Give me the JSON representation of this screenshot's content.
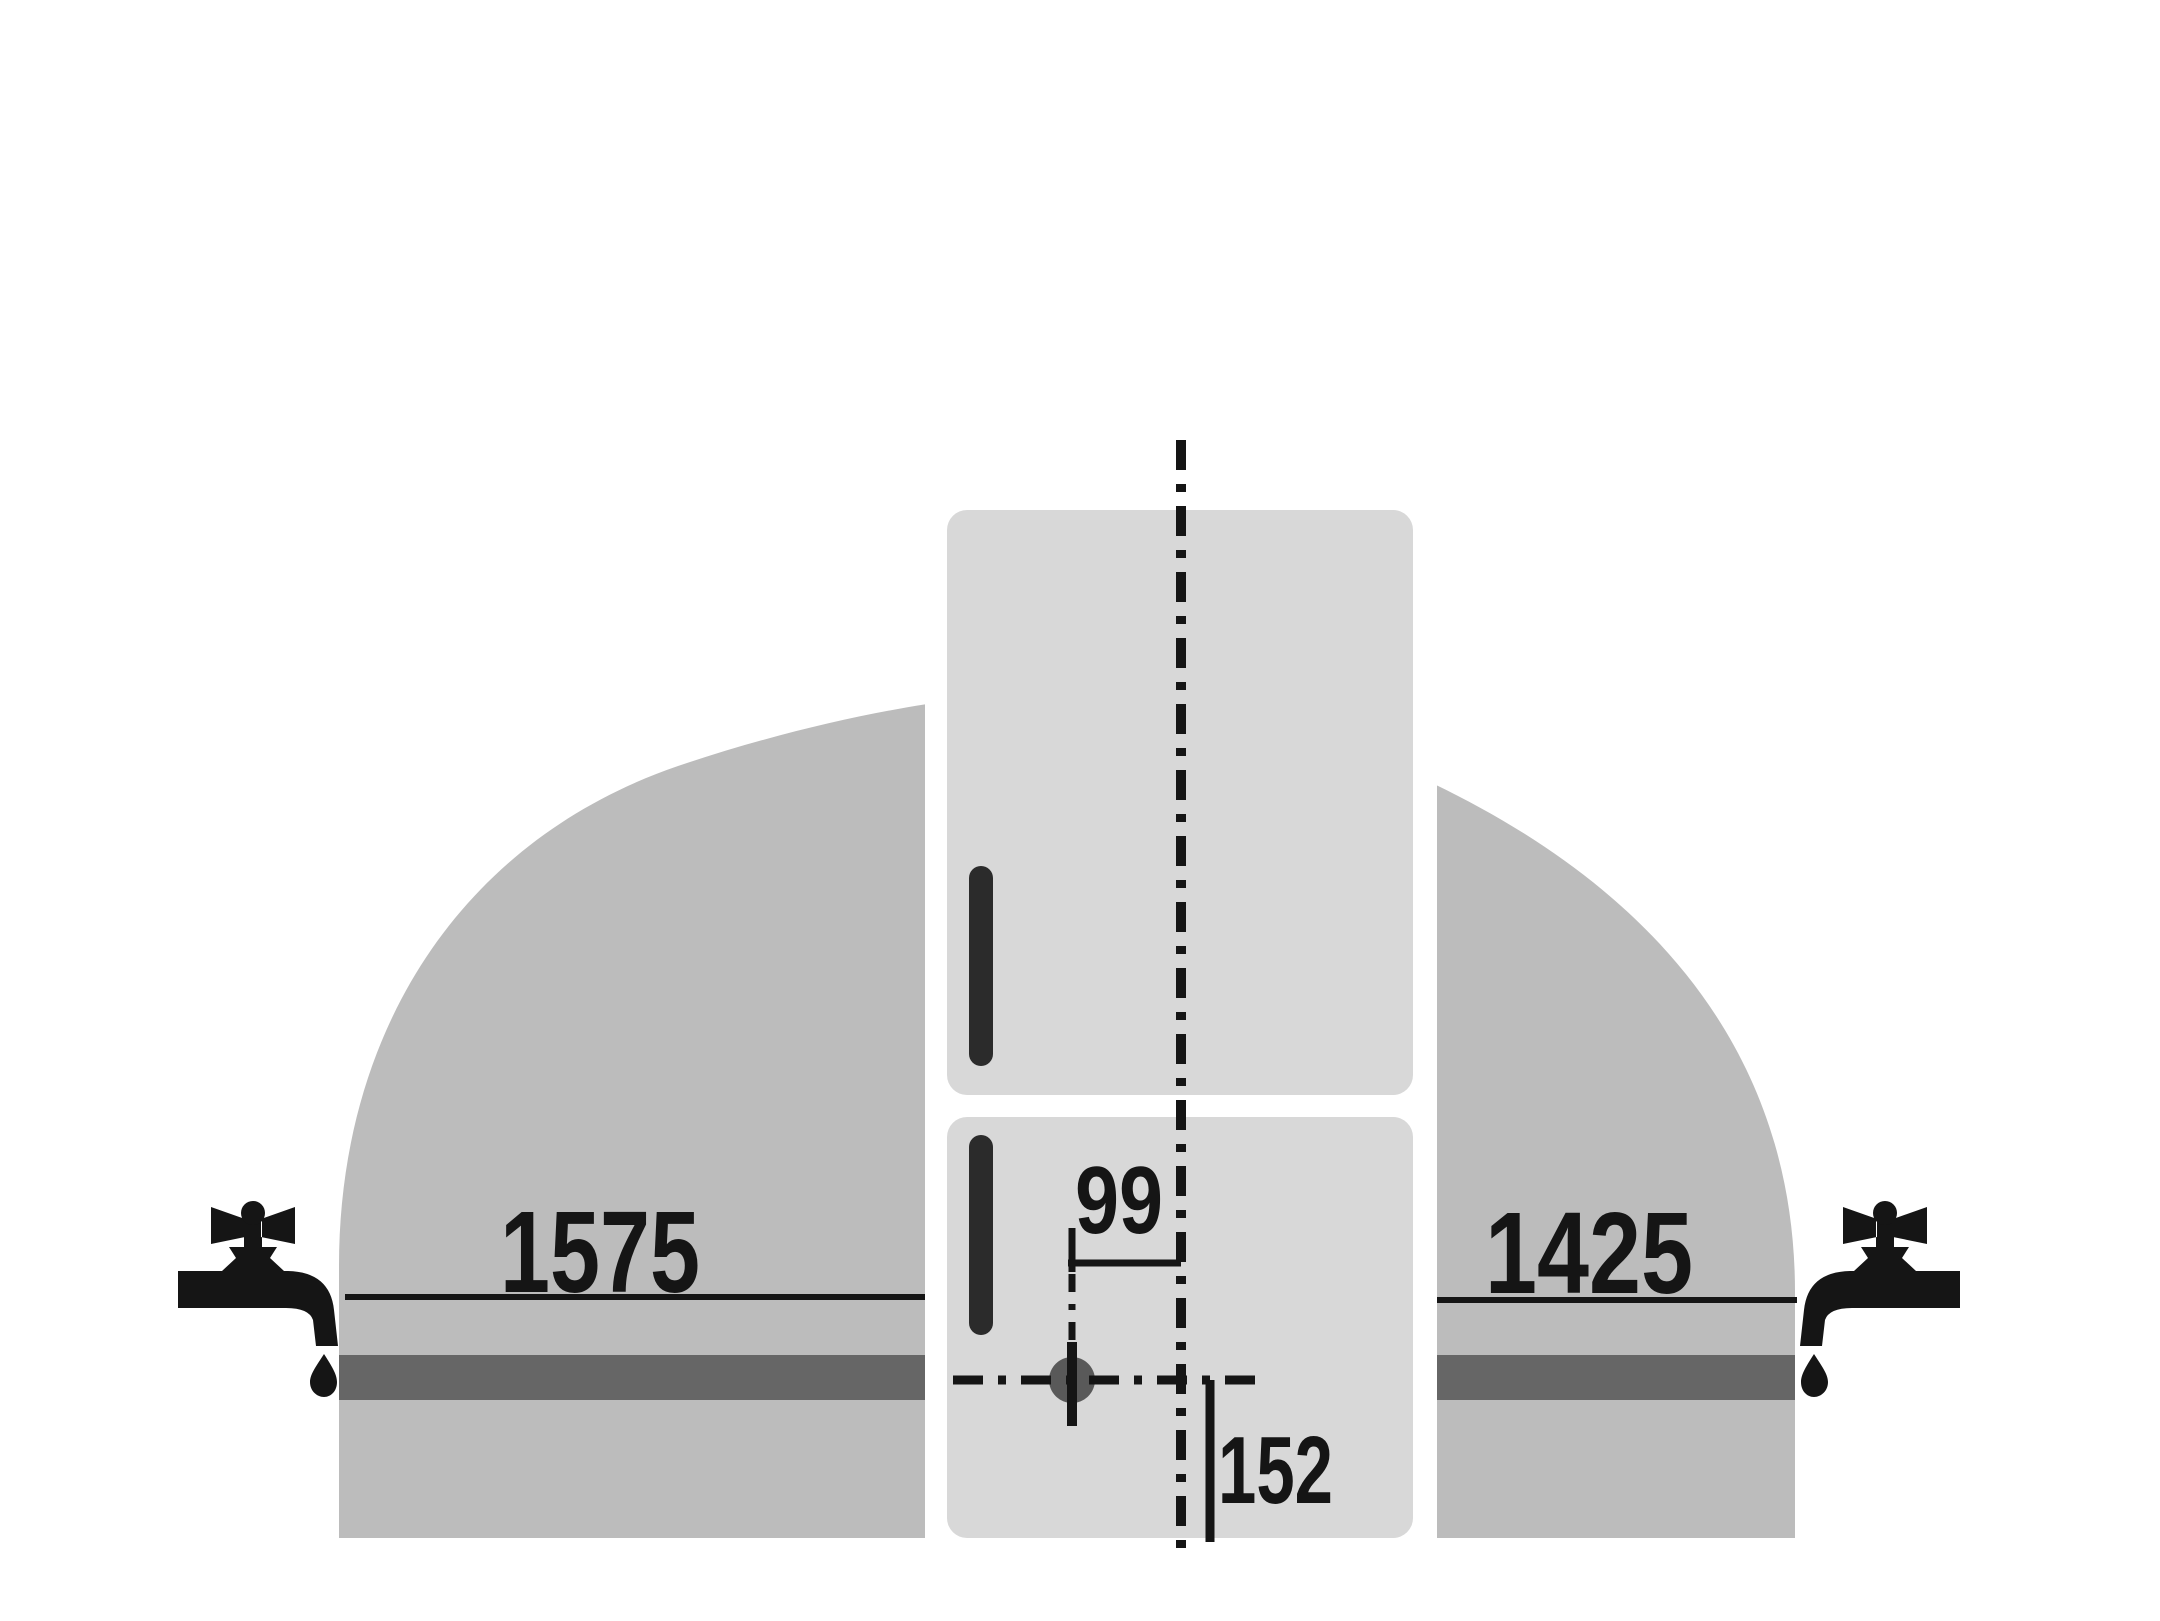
{
  "diagram": {
    "description": "appliance water connection clearance diagram",
    "dimensions": {
      "left_distance": "1575",
      "right_distance": "1425",
      "horizontal_offset": "99",
      "vertical_offset": "152"
    },
    "icons": {
      "left": "faucet-icon",
      "right": "faucet-icon",
      "marker": "water-connection-point"
    },
    "colors": {
      "background": "#ffffff",
      "reach_area": "#bcbcbc",
      "band": "#666666",
      "appliance": "#d8d8d8",
      "handle": "#2b2b2b",
      "marker": "#595959",
      "ink": "#151515"
    }
  }
}
